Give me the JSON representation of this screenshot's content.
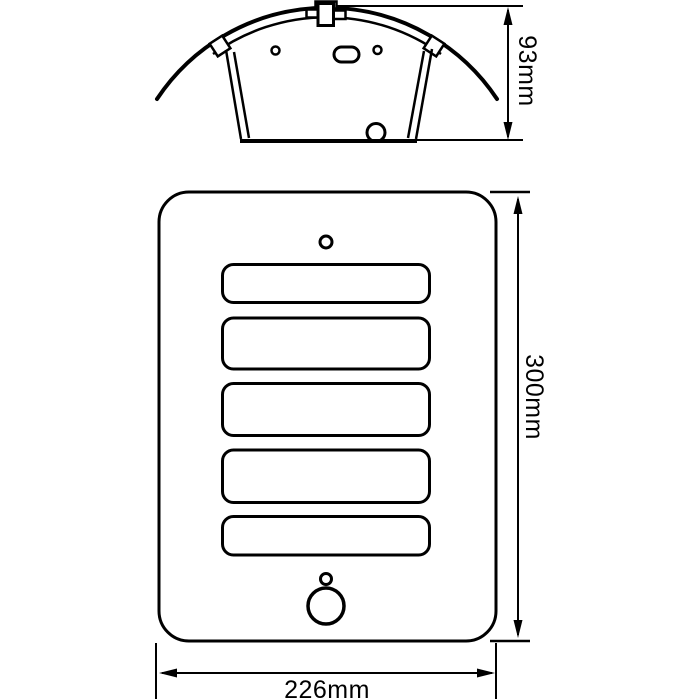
{
  "drawing": {
    "background_color": "#ffffff",
    "line_color": "#000000",
    "top_view": {
      "depth_label": "93mm"
    },
    "front_view": {
      "height_label": "300mm",
      "width_label": "226mm"
    }
  }
}
